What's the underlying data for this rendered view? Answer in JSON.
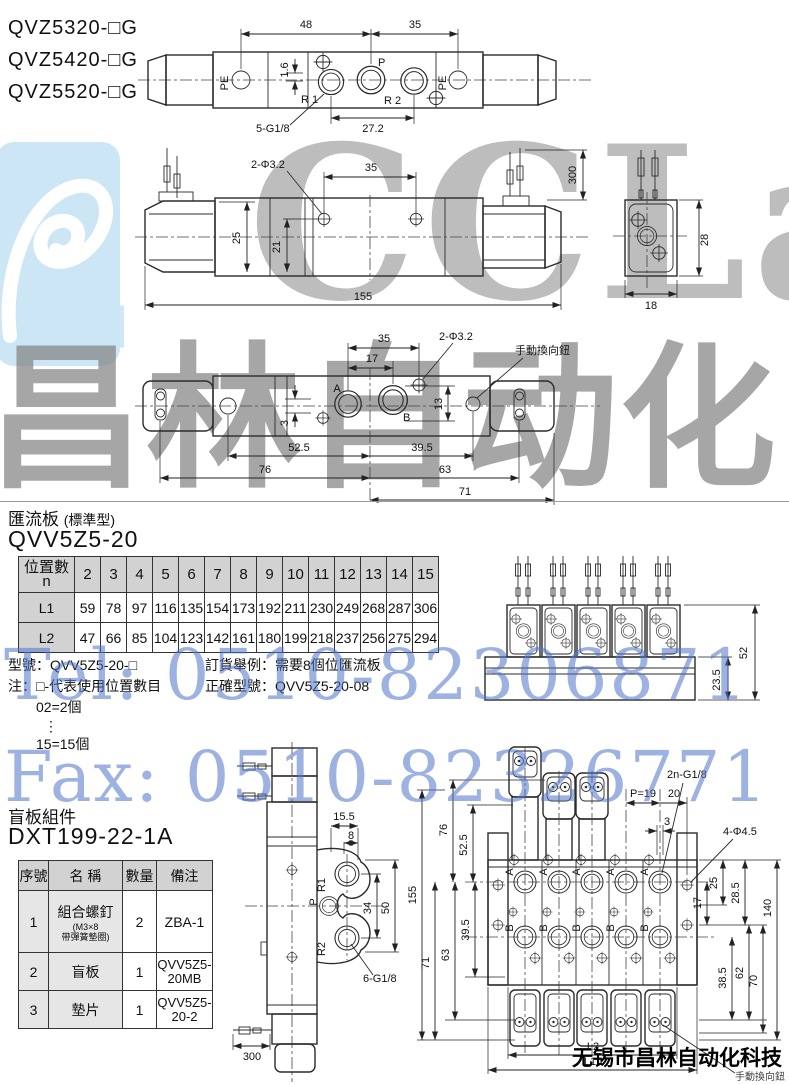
{
  "models": [
    "QVZ5320-□G",
    "QVZ5420-□G",
    "QVZ5520-□G"
  ],
  "sections": {
    "manifold_title": "匯流板",
    "manifold_title_sub": "(標準型)",
    "manifold_model": "QVV5Z5-20",
    "blind_title": "盲板組件",
    "blind_model": "DXT199-22-1A"
  },
  "manifold_table": {
    "corner": "位置數",
    "corner_sub": "n",
    "cols": [
      "2",
      "3",
      "4",
      "5",
      "6",
      "7",
      "8",
      "9",
      "10",
      "11",
      "12",
      "13",
      "14",
      "15"
    ],
    "l1_label": "L1",
    "l1": [
      "59",
      "78",
      "97",
      "116",
      "135",
      "154",
      "173",
      "192",
      "211",
      "230",
      "249",
      "268",
      "287",
      "306"
    ],
    "l2_label": "L2",
    "l2": [
      "47",
      "66",
      "85",
      "104",
      "123",
      "142",
      "161",
      "180",
      "199",
      "218",
      "237",
      "256",
      "275",
      "294"
    ]
  },
  "notes": {
    "model_line": "型號：QVV5Z5-20-□",
    "note_line": "注：□-代表使用位置數目",
    "eg_from": "02=2個",
    "dots": "⋮",
    "eg_to": "15=15個",
    "order_line1": "訂貨舉例：需要8個位匯流板",
    "order_line2": "正確型號：QVV5Z5-20-08"
  },
  "blind_table": {
    "headers": [
      "序號",
      "名  稱",
      "數量",
      "備注"
    ],
    "rows": [
      {
        "no": "1",
        "name": "組合螺釘",
        "name_sub": "(M3×8",
        "name_sub2": "帶彈簧墊圈)",
        "qty": "2",
        "remark": "ZBA-1"
      },
      {
        "no": "2",
        "name": "盲板",
        "qty": "1",
        "remark": "QVV5Z5-20MB"
      },
      {
        "no": "3",
        "name": "墊片",
        "qty": "1",
        "remark": "QVV5Z5-20-2"
      }
    ]
  },
  "dims": {
    "d1": {
      "d48": "48",
      "d35": "35",
      "d16": "1.6",
      "pe_l": "PE",
      "pe_r": "PE",
      "p": "P",
      "r1": "R 1",
      "r2": "R 2",
      "g18": "5-G1/8",
      "d272": "27.2"
    },
    "d2": {
      "phi": "2-Φ3.2",
      "d35": "35",
      "d300": "300",
      "d25": "25",
      "d21": "21",
      "d155": "155"
    },
    "d3": {
      "d28": "28",
      "d18": "18"
    },
    "d4": {
      "d35": "35",
      "d17": "17",
      "phi": "2-Φ3.2",
      "manual": "手動換向鈕",
      "a": "A",
      "b": "B",
      "d3": "3",
      "d13": "13",
      "d525": "52.5",
      "d395": "39.5",
      "d76": "76",
      "d63": "63",
      "d71": "71"
    },
    "d5": {
      "d52": "52",
      "d235": "23.5"
    },
    "d6": {
      "d155": "15.5",
      "d8": "8",
      "r1": "R1",
      "p": "P",
      "r2": "R2",
      "d34": "34",
      "d50": "50",
      "g18": "6-G1/8",
      "d300": "300"
    },
    "d7": {
      "d155": "155",
      "d71": "71",
      "d63": "63",
      "d76": "76",
      "d525": "52.5",
      "d395": "39.5",
      "g18": "2n-G1/8",
      "p19": "P=19",
      "d20": "20",
      "d3": "3",
      "phi": "4-Φ4.5",
      "d25": "25",
      "d285": "28.5",
      "d17": "17",
      "d385": "38.5",
      "d62": "62",
      "d70": "70",
      "d140": "140",
      "l2": "L2",
      "l1": "L1",
      "a": "A",
      "b": "B",
      "manual_label": "手動換向鈕"
    }
  },
  "watermarks": {
    "logo": "CCLair",
    "brand": "昌林自动化",
    "tel": "Tel: 0510-82306871",
    "fax": "Fax: 0510-82326771",
    "company": "无锡市昌林自动化科技"
  }
}
